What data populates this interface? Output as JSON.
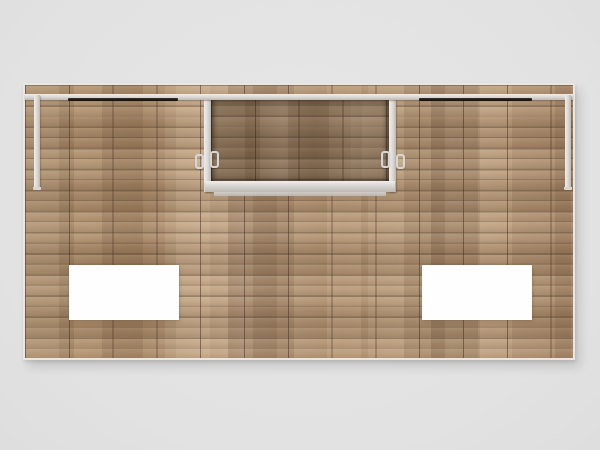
{
  "scene": {
    "type": "3d-product-render",
    "subject": "Straight wood-plank trade show exhibit back wall on a light gray studio background",
    "text_content": "none",
    "elements": {
      "wall": "full-width wood plank tile wall with visible tile grid seams",
      "top_rail": "continuous silver extrusion rail across the top of the wall",
      "end_posts": "short silver posts hanging from the rail at the far left and far right",
      "light_bars": [
        "recessed dark light bar, upper left",
        "recessed dark light bar, upper right"
      ],
      "monitor_recess": "shaded recessed niche at top center framed by silver posts with a silver bottom ledge and front lip",
      "mount_clips": "4 small silver bracket clips flanking the recess posts",
      "graphic_panels": [
        "blank white rectangular panel, lower left",
        "blank white rectangular panel, lower right"
      ]
    },
    "counts": {
      "light_bars": 2,
      "mount_clips": 4,
      "graphic_panels": 2
    }
  },
  "colors": {
    "background": "#e2e2e2",
    "background-hi": "#e7e7e7",
    "background-lo": "#dedede",
    "wall-edge": "#e9e6e3",
    "wood-base": "#b09273",
    "grid-line": "rgba(62,44,28,0.50)",
    "silver-hi": "#f0eeec",
    "silver": "#d8d5d2",
    "silver-lo": "#bcb8b4",
    "light-bar": "#17120e",
    "light-bar-hi": "#3a332c",
    "panel": "#fefefe"
  }
}
